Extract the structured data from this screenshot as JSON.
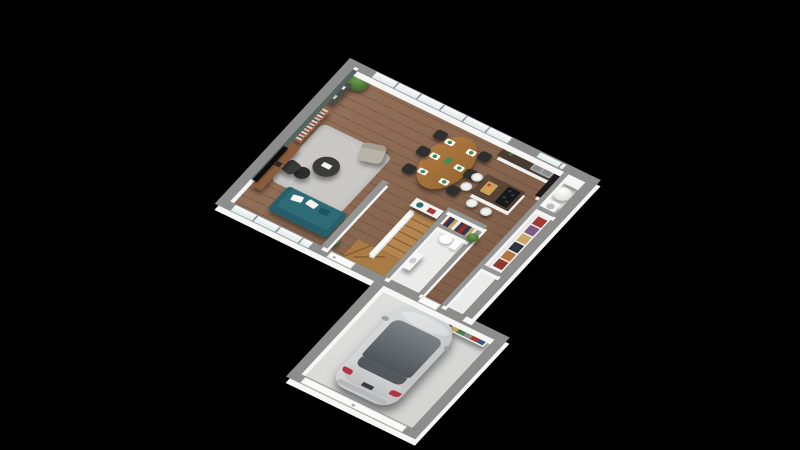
{
  "scene": {
    "description": "Isometric 3D render of a house ground floor plan on a black background",
    "background_color": "#000000",
    "projection": "isometric, rotated ~36 degrees, north corner at top"
  },
  "palette": {
    "wall_top": "#8d8d8d",
    "wall_face": "#f6f6f4",
    "accent_wall_green": "#55645d",
    "wood_floor": "#8a6850",
    "stair_wood": "#b5854f",
    "tile_floor": "#ebebe9",
    "garage_floor": "#d8d8d6",
    "rug_gray": "#c9c8c4",
    "sofa_teal": "#2e6b76",
    "armchair_beige": "#b6b2a5",
    "dining_wood": "#a8713e",
    "chair_black": "#2f2f2d",
    "counter_top_dark": "#4a3b33",
    "island_top_wood": "#5a4536",
    "car_silver": "#c9cbcd",
    "car_glass": "#5a6064",
    "taillight_red": "#b23440",
    "plant_green": "#4c7c38"
  },
  "rooms": [
    {
      "id": "living",
      "label": "Living room",
      "floor": "wood",
      "items": [
        "flat-screen TV on wooden stand",
        "dark green accent wall",
        "tall bookshelf with books",
        "dark console table",
        "corner plant",
        "gray rug",
        "two round black coffee tables",
        "beige armchair",
        "dark lounge chair",
        "teal sofa with white cushions",
        "potted plant beside sofa"
      ]
    },
    {
      "id": "dining",
      "label": "Dining area",
      "floor": "wood",
      "items": [
        "oval wooden table",
        "six black chairs",
        "six green place settings",
        "full-height window wall"
      ]
    },
    {
      "id": "kitchen",
      "label": "Kitchen",
      "floor": "wood",
      "items": [
        "counter with dark worktop and double sink",
        "bottles on counter",
        "tall black cabinet",
        "island with dark wood top and cooktop",
        "cutting board",
        "four white bar stools",
        "window above sink"
      ]
    },
    {
      "id": "hallway",
      "label": "Hallway / stairs",
      "floor": "wood",
      "items": [
        "winder staircase in light wood",
        "white banister wall",
        "front door",
        "white sideboard with teal lamp and red books"
      ]
    },
    {
      "id": "wardrobe",
      "label": "Wardrobe niche",
      "floor": "wood",
      "items": [
        "open shelves with colorful folded clothes"
      ]
    },
    {
      "id": "wc",
      "label": "WC",
      "floor": "tile",
      "items": [
        "toilet with cistern",
        "white washbasin cabinet",
        "plant on wall top"
      ]
    },
    {
      "id": "utility",
      "label": "Utility room",
      "floor": "tile",
      "items": [
        "white cylindrical water heater",
        "washing machine",
        "white wall cabinets"
      ]
    },
    {
      "id": "closet",
      "label": "Storage closet",
      "floor": "tile",
      "items": [
        "shelving with red, purple, tan and dark boxes/clothes"
      ]
    },
    {
      "id": "garage",
      "label": "Garage",
      "floor": "concrete",
      "items": [
        "silver hatchback car",
        "storage shelf with colorful items",
        "white sectional garage door",
        "access door to house"
      ]
    }
  ],
  "vehicle": {
    "type": "hatchback car",
    "color": "silver",
    "orientation": "nose toward the house, rear with red taillights at the garage door",
    "details": [
      "dark panoramic glass roof and windshield",
      "dark rear window",
      "red taillights",
      "gray bumper",
      "side mirrors"
    ]
  },
  "openings": {
    "windows": [
      "glazed wall along dining area",
      "window above kitchen sink",
      "living room windows on lower wall"
    ],
    "doors": [
      "front door",
      "garage access door",
      "wide garage door"
    ]
  }
}
